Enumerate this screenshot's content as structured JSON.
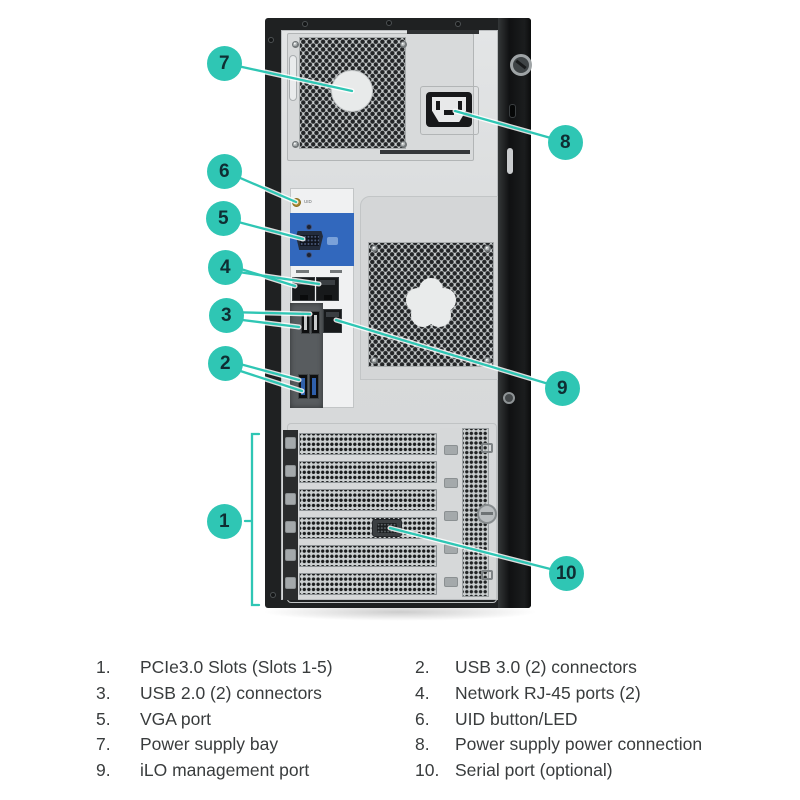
{
  "figure": {
    "description": "Rear view diagram of tower server with numbered callouts",
    "uid_label": "UID",
    "callouts": [
      {
        "num": "1",
        "x": 224,
        "y": 521
      },
      {
        "num": "2",
        "x": 225,
        "y": 363
      },
      {
        "num": "3",
        "x": 226,
        "y": 315
      },
      {
        "num": "4",
        "x": 225,
        "y": 267
      },
      {
        "num": "5",
        "x": 223,
        "y": 218
      },
      {
        "num": "6",
        "x": 224,
        "y": 171
      },
      {
        "num": "7",
        "x": 224,
        "y": 63
      },
      {
        "num": "8",
        "x": 565,
        "y": 142
      },
      {
        "num": "9",
        "x": 562,
        "y": 388
      },
      {
        "num": "10",
        "x": 566,
        "y": 573
      }
    ],
    "colors": {
      "teal": "#2fc6b4",
      "callout_text": "#0f2e33",
      "vga_blue": "#3268bd",
      "usb3_blue": "#2f5faa",
      "chassis_black": "#1f2122",
      "panel_silver": "#dcdedf",
      "legend_text": "#393c3d"
    }
  },
  "legend": {
    "columns": [
      {
        "side": "left",
        "items": [
          {
            "num": "1.",
            "label": "PCIe3.0 Slots (Slots 1-5)"
          },
          {
            "num": "3.",
            "label": "USB 2.0 (2) connectors"
          },
          {
            "num": "5.",
            "label": "VGA port"
          },
          {
            "num": "7.",
            "label": "Power supply bay"
          },
          {
            "num": "9.",
            "label": "iLO management port"
          }
        ]
      },
      {
        "side": "right",
        "items": [
          {
            "num": "2.",
            "label": "USB 3.0 (2) connectors"
          },
          {
            "num": "4.",
            "label": "Network RJ-45 ports (2)"
          },
          {
            "num": "6.",
            "label": "UID button/LED"
          },
          {
            "num": "8.",
            "label": "Power supply power connection"
          },
          {
            "num": "10.",
            "label": "Serial port (optional)"
          }
        ]
      }
    ]
  }
}
